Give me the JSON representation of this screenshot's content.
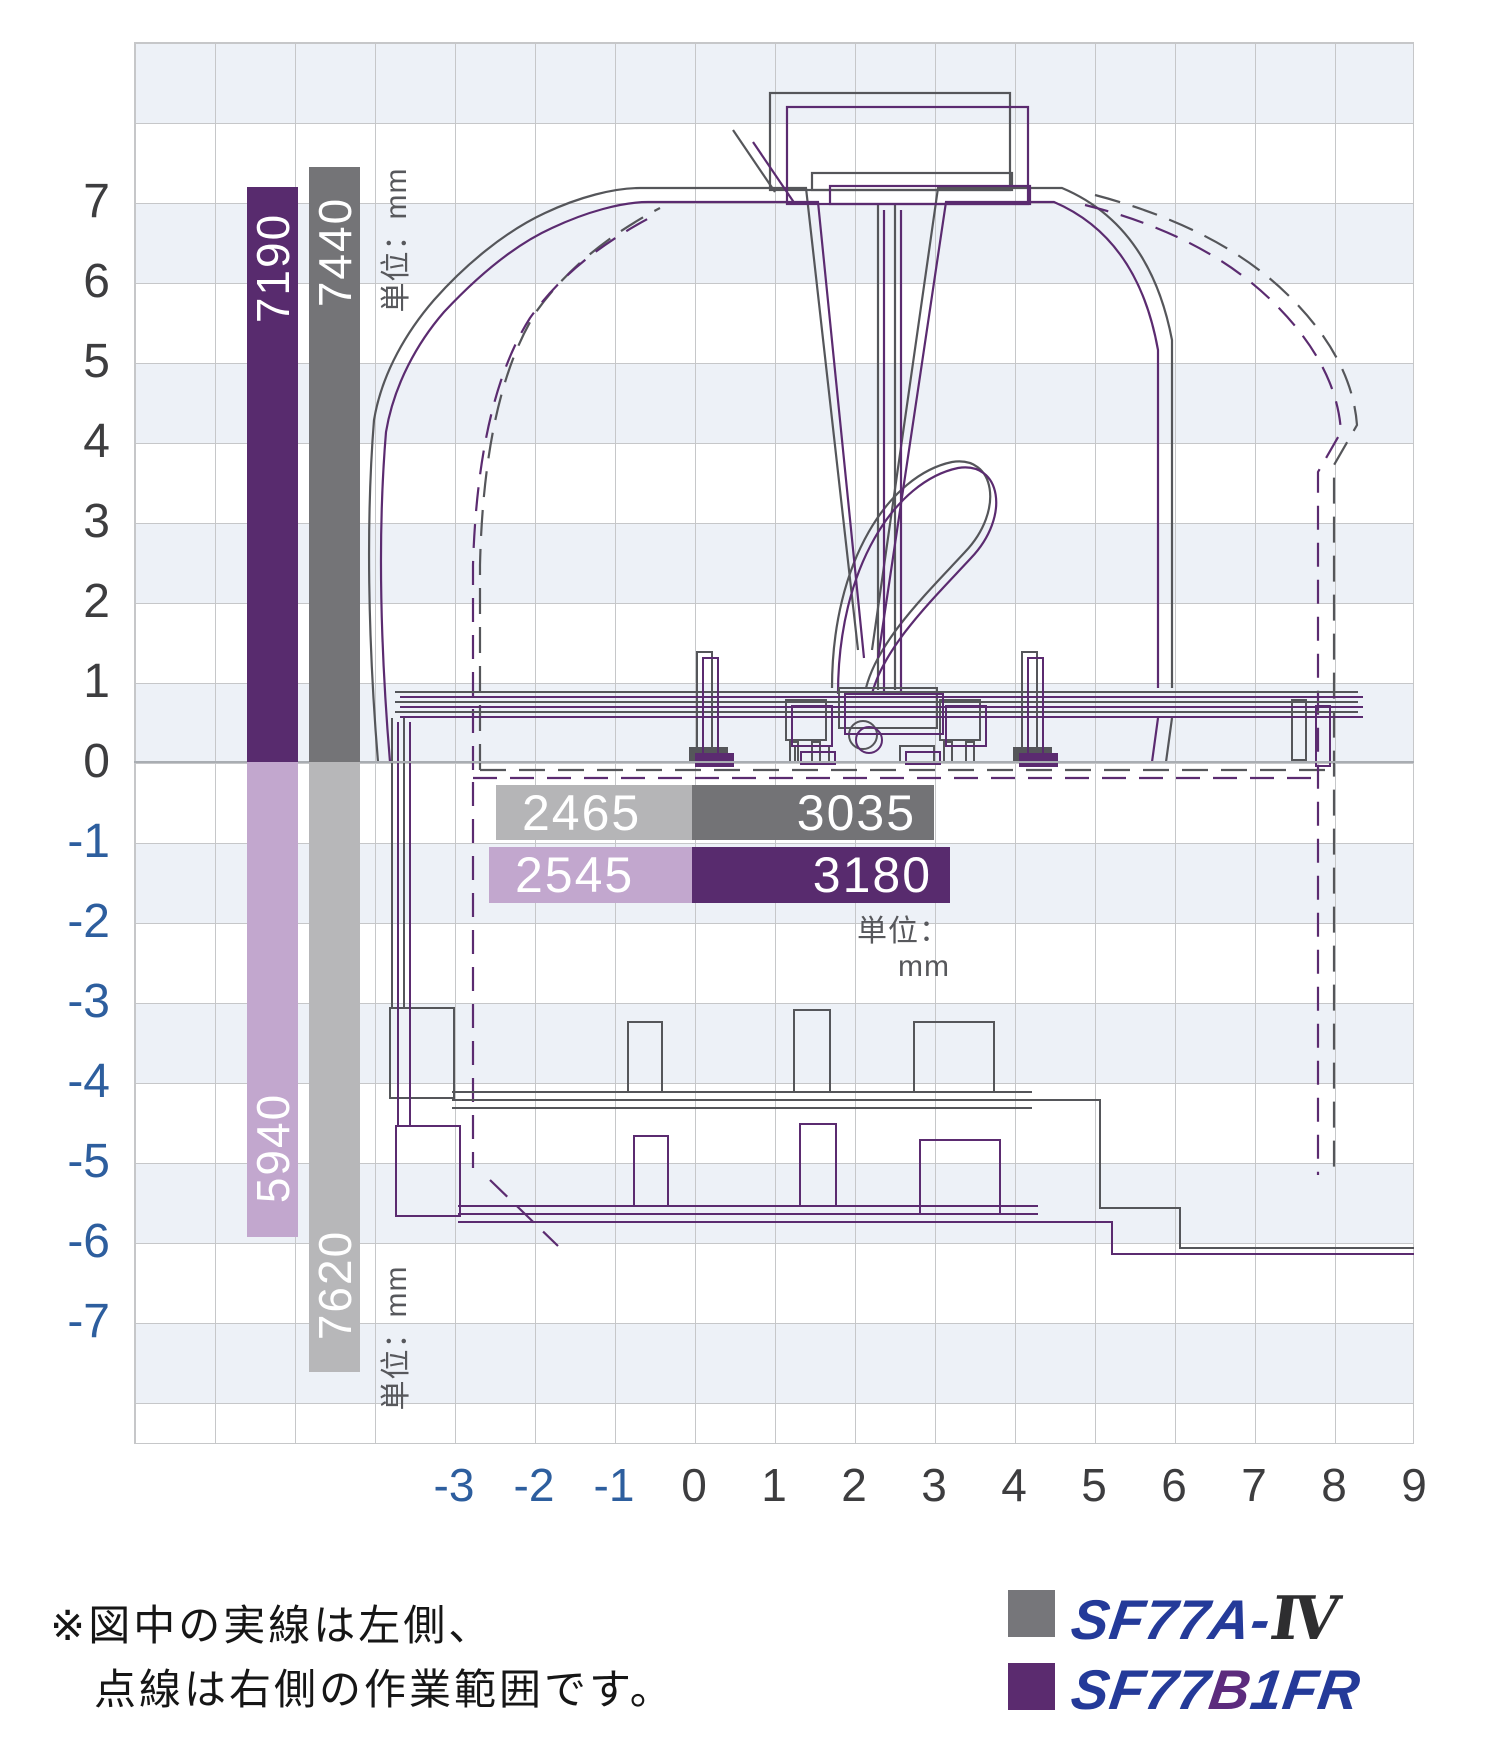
{
  "axes": {
    "x": [
      "-3",
      "-2",
      "-1",
      "0",
      "1",
      "2",
      "3",
      "4",
      "5",
      "6",
      "7",
      "8",
      "9"
    ],
    "y": [
      "7",
      "6",
      "5",
      "4",
      "3",
      "2",
      "1",
      "0",
      "-1",
      "-2",
      "-3",
      "-4",
      "-5",
      "-6",
      "-7"
    ]
  },
  "bars": {
    "unit_top": "単位：mm",
    "unit_bottom": "単位：mm",
    "unit_horizontal": "単位：mm",
    "height_sf77b1fr": "7190",
    "height_sf77a": "7440",
    "depth_sf77b1fr": "5940",
    "depth_sf77a": "7620",
    "left_sf77a": "2465",
    "right_sf77a": "3035",
    "left_sf77b1fr": "2545",
    "right_sf77b1fr": "3180"
  },
  "legend": {
    "items": [
      {
        "name": "SF77A-IV",
        "blue_part": "SF77A-",
        "roman_part": "Ⅳ",
        "color": "#76767a"
      },
      {
        "name": "SF77B1FR",
        "pre": "SF77",
        "mid": "B",
        "post": "1FR",
        "color": "#5b2b6f"
      }
    ]
  },
  "note": {
    "line1": "※図中の実線は左側、",
    "line2": "点線は右側の作業範囲です。"
  },
  "colors": {
    "purple_dark": "#582b6e",
    "purple_light": "#c2a7ce",
    "gray_dark": "#747477",
    "gray_light": "#b7b7b9",
    "band": "#edf1f7",
    "tick_negative": "#2d5e9e",
    "logo_blue": "#243a99"
  },
  "chart_data": {
    "type": "bar",
    "title": "作業範囲図（working range diagram）",
    "note": "実線＝左側、点線＝右側の作業範囲",
    "x_axis": {
      "ticks": [
        -3,
        -2,
        -1,
        0,
        1,
        2,
        3,
        4,
        5,
        6,
        7,
        8,
        9
      ],
      "unit": "m",
      "range": [
        -7,
        9
      ]
    },
    "y_axis": {
      "ticks": [
        7,
        6,
        5,
        4,
        3,
        2,
        1,
        0,
        -1,
        -2,
        -3,
        -4,
        -5,
        -6,
        -7
      ],
      "unit": "m",
      "range": [
        -8.5,
        9
      ]
    },
    "series": [
      {
        "name": "SF77A-IV",
        "color": "#76767a",
        "max_height_mm": 7440,
        "max_depth_mm": 7620,
        "reach_left_mm": 2465,
        "reach_right_mm": 3035
      },
      {
        "name": "SF77B1FR",
        "color": "#5b2b6f",
        "max_height_mm": 7190,
        "max_depth_mm": 5940,
        "reach_left_mm": 2545,
        "reach_right_mm": 3180
      }
    ]
  }
}
